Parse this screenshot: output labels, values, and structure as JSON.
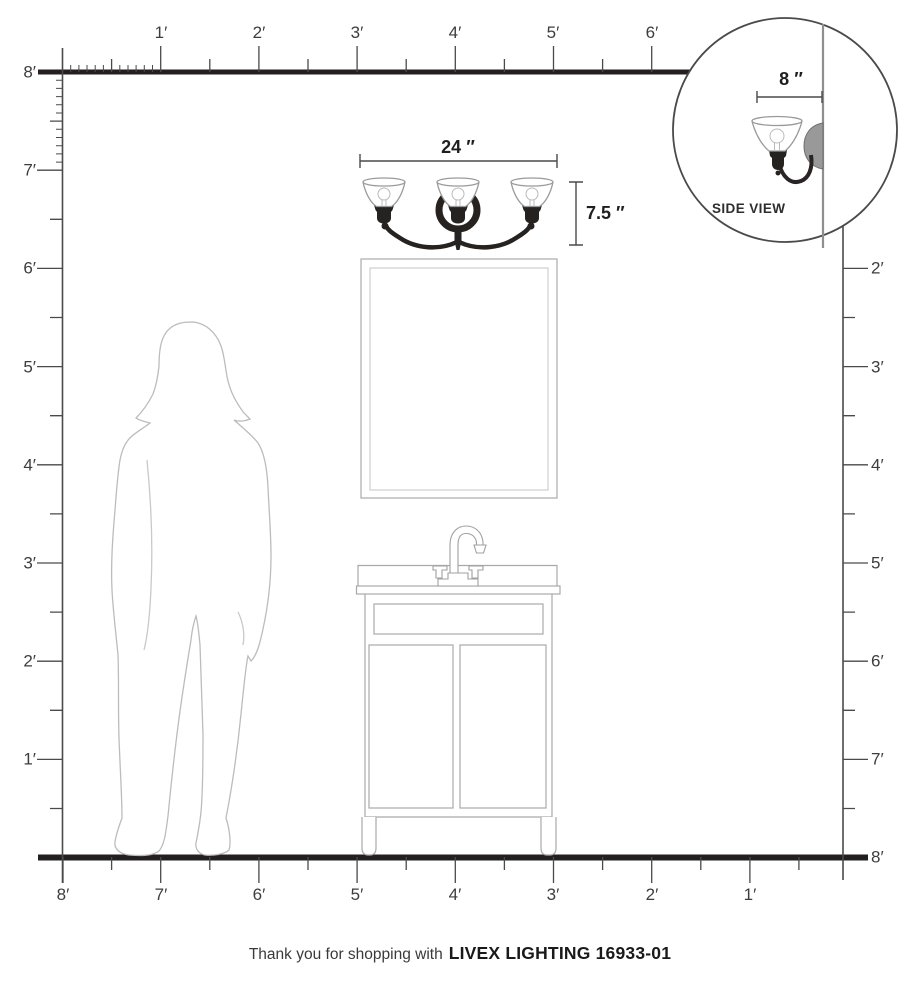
{
  "caption": {
    "prefix": "Thank you for shopping with",
    "brand": "LIVEX LIGHTING 16933-01"
  },
  "fixture": {
    "width_label": "24 ″",
    "height_label": "7.5 ″"
  },
  "side_view": {
    "label": "SIDE VIEW",
    "depth_label": "8 ″"
  },
  "rulers": {
    "top": [
      "1′",
      "2′",
      "3′",
      "4′",
      "5′",
      "6′"
    ],
    "left": [
      "8′",
      "7′",
      "6′",
      "5′",
      "4′",
      "3′",
      "2′",
      "1′"
    ],
    "right": [
      "2′",
      "3′",
      "4′",
      "5′",
      "6′",
      "7′",
      "8′"
    ],
    "bottom": [
      "8′",
      "7′",
      "6′",
      "5′",
      "4′",
      "3′",
      "2′",
      "1′"
    ]
  },
  "colors": {
    "ruler_line": "#4a4a4a",
    "frame_black": "#231f20",
    "label_text": "#3d3d3d",
    "fixture_black": "#262220",
    "line_art_gray": "#a9a9a9",
    "silhouette_gray": "#bcbcbc",
    "dimension_text": "#1f1f1f"
  }
}
